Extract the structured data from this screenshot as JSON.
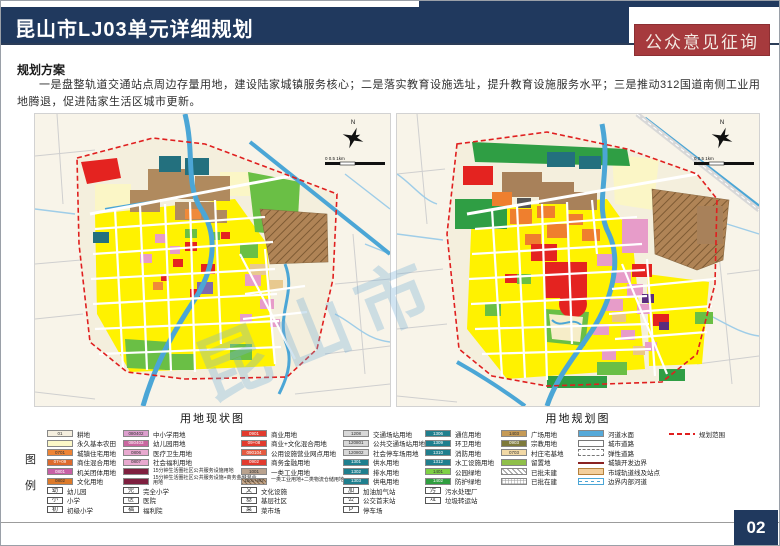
{
  "header": {
    "title": "昆山市LJ03单元详细规划",
    "badge": "公众意见征询"
  },
  "section": {
    "heading": "规划方案",
    "paragraph": "一是盘整轨道交通站点周边存量用地，建设陆家城镇服务核心；二是落实教育设施选址，提升教育设施服务水平；三是推动312国道南侧工业用地腾退，促进陆家生活区城市更新。"
  },
  "maps": {
    "left_title": "用地现状图",
    "right_title": "用地规划图",
    "north_label": "N",
    "scale_text": "0  0.5  1km",
    "watermark": "昆山市"
  },
  "colors": {
    "navy": "#20395e",
    "badge_red": "#a63a3d",
    "boundary_red": "#e01f1f",
    "water_blue": "#4ba6d6",
    "parcel_yellow": "#fff200"
  },
  "legend": {
    "label": "图例",
    "columns": [
      {
        "items": [
          {
            "t": "sw",
            "c": "#f5efdf",
            "code": "01",
            "label": "耕地"
          },
          {
            "t": "sw",
            "c": "#fcf8c8",
            "code": "",
            "label": "永久基本农田"
          },
          {
            "t": "sw",
            "c": "#ee8435",
            "code": "0701",
            "label": "城镇住宅用地"
          },
          {
            "t": "sw",
            "c": "#dd6a2c",
            "code": "07+09",
            "label": "商住混合用地"
          },
          {
            "t": "sw",
            "c": "#c75fa5",
            "code": "0801",
            "label": "机关团体用地"
          },
          {
            "t": "sw",
            "c": "#dd7a2a",
            "code": "0802",
            "label": "文化用地"
          },
          {
            "t": "icon",
            "glyph": "幼",
            "label": "幼儿园"
          },
          {
            "t": "icon",
            "glyph": "小",
            "label": "小学"
          },
          {
            "t": "icon",
            "glyph": "初",
            "label": "初级小学"
          }
        ]
      },
      {
        "items": [
          {
            "t": "sw",
            "c": "#dd9fce",
            "code": "080402",
            "label": "中小学用地"
          },
          {
            "t": "sw",
            "c": "#c9679f",
            "code": "080403",
            "label": "幼儿园用地"
          },
          {
            "t": "sw",
            "c": "#e8a9cf",
            "code": "0806",
            "label": "医疗卫生用地"
          },
          {
            "t": "sw",
            "c": "#e8a9cf",
            "code": "0807",
            "label": "社会福利用地"
          },
          {
            "t": "sw",
            "c": "#7e1f3f",
            "code": "",
            "label": "15分钟生活圈社区公共服务设施用地",
            "small": true
          },
          {
            "t": "sw",
            "c": "#7e1f3f",
            "code": "",
            "label": "15分钟生活圈社区公共服务设施+商务金融混合用地",
            "small": true
          },
          {
            "t": "icon",
            "glyph": "完",
            "label": "完全小学"
          },
          {
            "t": "icon",
            "glyph": "医",
            "label": "医院"
          },
          {
            "t": "icon",
            "glyph": "福",
            "label": "福利院"
          }
        ]
      },
      {
        "items": [
          {
            "t": "sw",
            "c": "#e23b2e",
            "code": "0901",
            "label": "商业用地"
          },
          {
            "t": "sw",
            "c": "#e23b2e",
            "code": "09+08",
            "label": "商业+文化混合用地"
          },
          {
            "t": "sw",
            "c": "#e55a40",
            "code": "090104",
            "label": "公用设施营业网点用地"
          },
          {
            "t": "sw",
            "c": "#e23b2e",
            "code": "0902",
            "label": "商务金融用地"
          },
          {
            "t": "sw",
            "c": "#b9a28e",
            "code": "1001",
            "label": "一类工业用地"
          },
          {
            "t": "sw",
            "c": "",
            "code": "1001+W2",
            "label": "一类工业用地+二类物流仓储用地",
            "small": true,
            "cls": "tanhatch"
          },
          {
            "t": "icon",
            "glyph": "文",
            "label": "文化设施"
          },
          {
            "t": "icon",
            "glyph": "基",
            "label": "基层社区"
          },
          {
            "t": "icon",
            "glyph": "菜",
            "label": "菜市场"
          }
        ]
      },
      {
        "items": [
          {
            "t": "sw",
            "c": "#d8d8d8",
            "code": "1208",
            "label": "交通场站用地"
          },
          {
            "t": "sw",
            "c": "#d8d8d8",
            "code": "120801",
            "label": "公共交通场站用地"
          },
          {
            "t": "sw",
            "c": "#d8d8d8",
            "code": "120802",
            "label": "社会停车场用地"
          },
          {
            "t": "sw",
            "c": "#1f7f8e",
            "code": "1301",
            "label": "供水用地"
          },
          {
            "t": "sw",
            "c": "#1f7f8e",
            "code": "1302",
            "label": "排水用地"
          },
          {
            "t": "sw",
            "c": "#1f7f8e",
            "code": "1303",
            "label": "供电用地"
          },
          {
            "t": "icon",
            "glyph": "加",
            "label": "加油加气站"
          },
          {
            "t": "icon",
            "glyph": "公",
            "label": "公交首末站"
          },
          {
            "t": "icon",
            "glyph": "P",
            "label": "停车场"
          }
        ]
      },
      {
        "items": [
          {
            "t": "sw",
            "c": "#1f7f8e",
            "code": "1306",
            "label": "通信用地"
          },
          {
            "t": "sw",
            "c": "#1f7f8e",
            "code": "1309",
            "label": "环卫用地"
          },
          {
            "t": "sw",
            "c": "#1f7f8e",
            "code": "1310",
            "label": "消防用地"
          },
          {
            "t": "sw",
            "c": "#1f7f8e",
            "code": "1312",
            "label": "水工设施用地"
          },
          {
            "t": "sw",
            "c": "#7ed145",
            "code": "1401",
            "label": "公园绿地"
          },
          {
            "t": "sw",
            "c": "#2f9e3f",
            "code": "1402",
            "label": "防护绿地"
          },
          {
            "t": "icon",
            "glyph": "污",
            "label": "污水处理厂"
          },
          {
            "t": "icon",
            "glyph": "垃",
            "label": "垃圾转运站"
          }
        ]
      },
      {
        "items": [
          {
            "t": "sw",
            "c": "#c59a56",
            "code": "1403",
            "label": "广场用地"
          },
          {
            "t": "sw",
            "c": "#7e7a3c",
            "code": "0903",
            "label": "宗教用地"
          },
          {
            "t": "sw",
            "c": "#f2d9a6",
            "code": "0703",
            "label": "村庄宅基地"
          },
          {
            "t": "sw",
            "c": "#8fbf4a",
            "code": "",
            "label": "留置地"
          },
          {
            "t": "sw",
            "c": "",
            "code": "",
            "label": "已批未建",
            "cls": "hatch"
          },
          {
            "t": "sw",
            "c": "",
            "code": "",
            "label": "已批在建",
            "cls": "cross"
          }
        ]
      },
      {
        "items": [
          {
            "t": "sw",
            "c": "#55a9d9",
            "code": "",
            "label": "河道水面"
          },
          {
            "t": "sw",
            "c": "",
            "code": "",
            "label": "城市道路",
            "cls": "road"
          },
          {
            "t": "sw",
            "c": "",
            "code": "",
            "label": "弹性道路",
            "cls": "dashroad"
          },
          {
            "t": "sw",
            "c": "",
            "code": "",
            "label": "城镇开发边界",
            "cls": "redline"
          },
          {
            "t": "sw",
            "c": "",
            "code": "",
            "label": "市域轨道线及站点",
            "cls": "band"
          },
          {
            "t": "sw",
            "c": "",
            "code": "",
            "label": "边界内部河道",
            "cls": "bluedash"
          }
        ]
      },
      {
        "items": [
          {
            "t": "sw",
            "c": "",
            "code": "",
            "label": "规划范围",
            "cls": "reddash"
          }
        ]
      }
    ]
  },
  "footer": {
    "page_number": "02"
  }
}
